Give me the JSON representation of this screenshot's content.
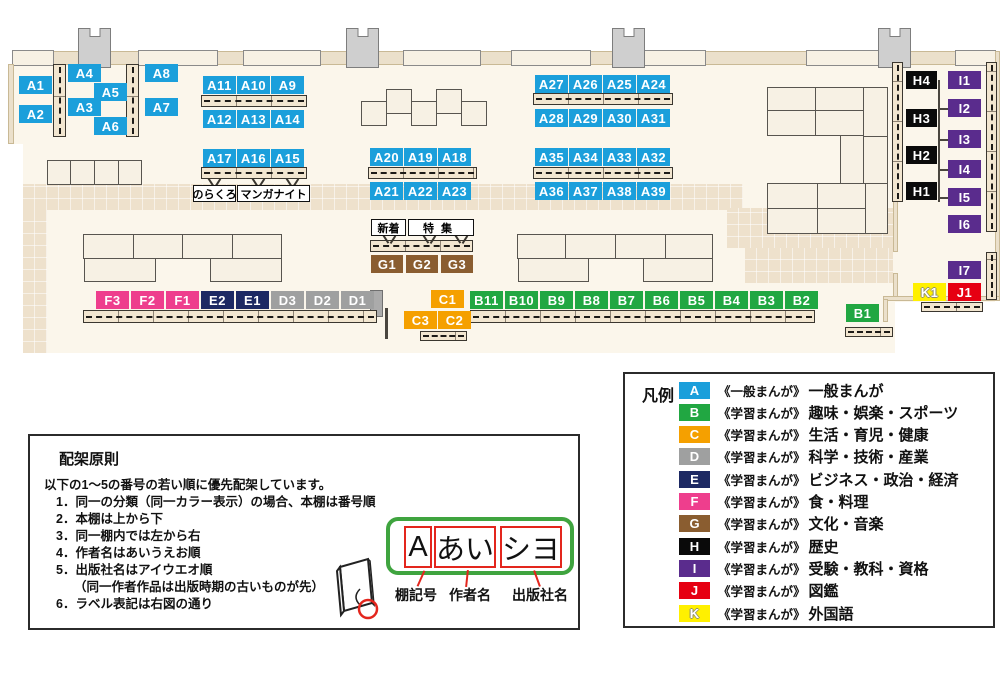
{
  "map": {
    "colors": {
      "A": "#1B9FDB",
      "B": "#21A742",
      "C": "#F5A000",
      "D": "#9FA0A0",
      "E": "#1D2963",
      "F": "#EE3E8D",
      "G": "#8A5D30",
      "H": "#0A0A0A",
      "I": "#5A2C8D",
      "J": "#E60012",
      "K": "#FFF000"
    },
    "labels": [
      {
        "t": "A1",
        "c": "A",
        "x": 19,
        "y": 76
      },
      {
        "t": "A2",
        "c": "A",
        "x": 19,
        "y": 105
      },
      {
        "t": "A4",
        "c": "A",
        "x": 68,
        "y": 64
      },
      {
        "t": "A5",
        "c": "A",
        "x": 94,
        "y": 83
      },
      {
        "t": "A3",
        "c": "A",
        "x": 68,
        "y": 98
      },
      {
        "t": "A6",
        "c": "A",
        "x": 94,
        "y": 117
      },
      {
        "t": "A8",
        "c": "A",
        "x": 145,
        "y": 64
      },
      {
        "t": "A7",
        "c": "A",
        "x": 145,
        "y": 98
      },
      {
        "t": "A11",
        "c": "A",
        "x": 203,
        "y": 76
      },
      {
        "t": "A10",
        "c": "A",
        "x": 237,
        "y": 76
      },
      {
        "t": "A9",
        "c": "A",
        "x": 271,
        "y": 76
      },
      {
        "t": "A12",
        "c": "A",
        "x": 203,
        "y": 110
      },
      {
        "t": "A13",
        "c": "A",
        "x": 237,
        "y": 110
      },
      {
        "t": "A14",
        "c": "A",
        "x": 271,
        "y": 110
      },
      {
        "t": "A17",
        "c": "A",
        "x": 203,
        "y": 149
      },
      {
        "t": "A16",
        "c": "A",
        "x": 237,
        "y": 149
      },
      {
        "t": "A15",
        "c": "A",
        "x": 271,
        "y": 149
      },
      {
        "t": "A20",
        "c": "A",
        "x": 370,
        "y": 148
      },
      {
        "t": "A19",
        "c": "A",
        "x": 404,
        "y": 148
      },
      {
        "t": "A18",
        "c": "A",
        "x": 438,
        "y": 148
      },
      {
        "t": "A21",
        "c": "A",
        "x": 370,
        "y": 182
      },
      {
        "t": "A22",
        "c": "A",
        "x": 404,
        "y": 182
      },
      {
        "t": "A23",
        "c": "A",
        "x": 438,
        "y": 182
      },
      {
        "t": "A27",
        "c": "A",
        "x": 535,
        "y": 75
      },
      {
        "t": "A26",
        "c": "A",
        "x": 569,
        "y": 75
      },
      {
        "t": "A25",
        "c": "A",
        "x": 603,
        "y": 75
      },
      {
        "t": "A24",
        "c": "A",
        "x": 637,
        "y": 75
      },
      {
        "t": "A28",
        "c": "A",
        "x": 535,
        "y": 109
      },
      {
        "t": "A29",
        "c": "A",
        "x": 569,
        "y": 109
      },
      {
        "t": "A30",
        "c": "A",
        "x": 603,
        "y": 109
      },
      {
        "t": "A31",
        "c": "A",
        "x": 637,
        "y": 109
      },
      {
        "t": "A35",
        "c": "A",
        "x": 535,
        "y": 148
      },
      {
        "t": "A34",
        "c": "A",
        "x": 569,
        "y": 148
      },
      {
        "t": "A33",
        "c": "A",
        "x": 603,
        "y": 148
      },
      {
        "t": "A32",
        "c": "A",
        "x": 637,
        "y": 148
      },
      {
        "t": "A36",
        "c": "A",
        "x": 535,
        "y": 182
      },
      {
        "t": "A37",
        "c": "A",
        "x": 569,
        "y": 182
      },
      {
        "t": "A38",
        "c": "A",
        "x": 603,
        "y": 182
      },
      {
        "t": "A39",
        "c": "A",
        "x": 637,
        "y": 182
      },
      {
        "t": "F3",
        "c": "F",
        "x": 96,
        "y": 291
      },
      {
        "t": "F2",
        "c": "F",
        "x": 131,
        "y": 291
      },
      {
        "t": "F1",
        "c": "F",
        "x": 166,
        "y": 291
      },
      {
        "t": "E2",
        "c": "E",
        "x": 201,
        "y": 291
      },
      {
        "t": "E1",
        "c": "E",
        "x": 236,
        "y": 291
      },
      {
        "t": "D3",
        "c": "D",
        "x": 271,
        "y": 291
      },
      {
        "t": "D2",
        "c": "D",
        "x": 306,
        "y": 291
      },
      {
        "t": "D1",
        "c": "D",
        "x": 341,
        "y": 291
      },
      {
        "t": "C1",
        "c": "C",
        "x": 431,
        "y": 290
      },
      {
        "t": "C3",
        "c": "C",
        "x": 404,
        "y": 311
      },
      {
        "t": "C2",
        "c": "C",
        "x": 438,
        "y": 311
      },
      {
        "t": "B11",
        "c": "B",
        "x": 470,
        "y": 291
      },
      {
        "t": "B10",
        "c": "B",
        "x": 505,
        "y": 291
      },
      {
        "t": "B9",
        "c": "B",
        "x": 540,
        "y": 291
      },
      {
        "t": "B8",
        "c": "B",
        "x": 575,
        "y": 291
      },
      {
        "t": "B7",
        "c": "B",
        "x": 610,
        "y": 291
      },
      {
        "t": "B6",
        "c": "B",
        "x": 645,
        "y": 291
      },
      {
        "t": "B5",
        "c": "B",
        "x": 680,
        "y": 291
      },
      {
        "t": "B4",
        "c": "B",
        "x": 715,
        "y": 291
      },
      {
        "t": "B3",
        "c": "B",
        "x": 750,
        "y": 291
      },
      {
        "t": "B2",
        "c": "B",
        "x": 785,
        "y": 291
      },
      {
        "t": "G1",
        "c": "G",
        "x": 371,
        "y": 255,
        "w": 32
      },
      {
        "t": "G2",
        "c": "G",
        "x": 406,
        "y": 255,
        "w": 32
      },
      {
        "t": "G3",
        "c": "G",
        "x": 441,
        "y": 255,
        "w": 32
      },
      {
        "t": "B1",
        "c": "B",
        "x": 846,
        "y": 304
      },
      {
        "t": "H4",
        "c": "H",
        "x": 906,
        "y": 71,
        "w": 31
      },
      {
        "t": "H3",
        "c": "H",
        "x": 906,
        "y": 109,
        "w": 31
      },
      {
        "t": "H2",
        "c": "H",
        "x": 906,
        "y": 146,
        "w": 31
      },
      {
        "t": "H1",
        "c": "H",
        "x": 906,
        "y": 182,
        "w": 31
      },
      {
        "t": "I1",
        "c": "I",
        "x": 948,
        "y": 71
      },
      {
        "t": "I2",
        "c": "I",
        "x": 948,
        "y": 99
      },
      {
        "t": "I3",
        "c": "I",
        "x": 948,
        "y": 130
      },
      {
        "t": "I4",
        "c": "I",
        "x": 948,
        "y": 160
      },
      {
        "t": "I5",
        "c": "I",
        "x": 948,
        "y": 188
      },
      {
        "t": "I6",
        "c": "I",
        "x": 948,
        "y": 215
      },
      {
        "t": "I7",
        "c": "I",
        "x": 948,
        "y": 261
      },
      {
        "t": "K1",
        "c": "K",
        "x": 913,
        "y": 283
      },
      {
        "t": "J1",
        "c": "J",
        "x": 948,
        "y": 283
      }
    ],
    "annotations": [
      {
        "t": "のらくろ",
        "x": 193,
        "y": 185,
        "w": 43,
        "h": 17
      },
      {
        "t": "マンガナイト",
        "x": 237,
        "y": 185,
        "w": 73,
        "h": 17
      },
      {
        "t": "新着",
        "x": 371,
        "y": 219,
        "w": 35,
        "h": 17
      },
      {
        "t": "特集",
        "x": 408,
        "y": 219,
        "w": 66,
        "h": 17,
        "ls": 7
      }
    ]
  },
  "legend": {
    "title": "凡例",
    "items": [
      {
        "code": "A",
        "type": "《一般まんが》",
        "label": "一般まんが"
      },
      {
        "code": "B",
        "type": "《学習まんが》",
        "label": "趣味・娯楽・スポーツ"
      },
      {
        "code": "C",
        "type": "《学習まんが》",
        "label": "生活・育児・健康"
      },
      {
        "code": "D",
        "type": "《学習まんが》",
        "label": "科学・技術・産業"
      },
      {
        "code": "E",
        "type": "《学習まんが》",
        "label": "ビジネス・政治・経済"
      },
      {
        "code": "F",
        "type": "《学習まんが》",
        "label": "食・料理"
      },
      {
        "code": "G",
        "type": "《学習まんが》",
        "label": "文化・音楽"
      },
      {
        "code": "H",
        "type": "《学習まんが》",
        "label": "歴史"
      },
      {
        "code": "I",
        "type": "《学習まんが》",
        "label": "受験・教科・資格"
      },
      {
        "code": "J",
        "type": "《学習まんが》",
        "label": "図鑑"
      },
      {
        "code": "K",
        "type": "《学習まんが》",
        "label": "外国語"
      }
    ]
  },
  "principles": {
    "title": "配架原則",
    "intro": "以下の1～5の番号の若い順に優先配架しています。",
    "items": [
      "1．同一の分類（同一カラー表示）の場合、本棚は番号順",
      "2．本棚は上から下",
      "3．同一棚内では左から右",
      "4．作者名はあいうえお順",
      "5．出版社名はアイウエオ順",
      "（同一作者作品は出版時期の古いものが先）",
      "6．ラベル表記は右図の通り"
    ]
  },
  "label_diagram": {
    "segments": [
      {
        "text": "A",
        "caption": "棚記号"
      },
      {
        "text": "あい",
        "caption": "作者名"
      },
      {
        "text": "シヨ",
        "caption": "出版社名"
      }
    ]
  }
}
